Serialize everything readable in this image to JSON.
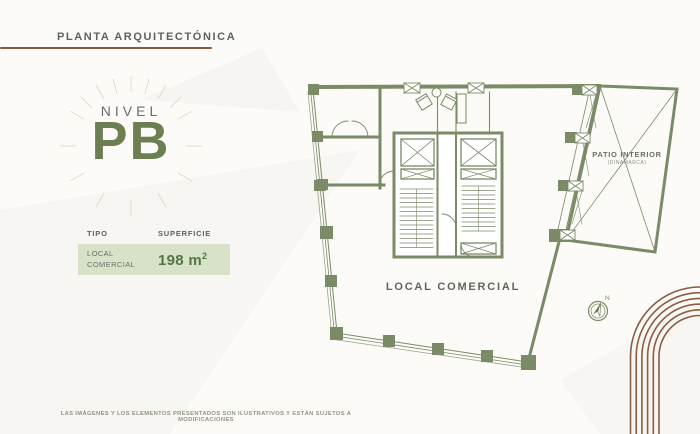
{
  "header": {
    "title": "PLANTA ARQUITECTÓNICA",
    "accent_color": "#8a573b"
  },
  "level": {
    "label": "NIVEL",
    "value": "PB",
    "value_color": "#6b7f52"
  },
  "summary_table": {
    "columns": [
      "TIPO",
      "SUPERFICIE"
    ],
    "row": {
      "tipo": "LOCAL COMERCIAL",
      "superficie_value": "198 m",
      "superficie_sup": "2"
    },
    "row_bg": "#d7e2c8",
    "value_color": "#55744a"
  },
  "plan": {
    "labels": {
      "local": "LOCAL COMERCIAL",
      "patio_title": "PATIO INTERIOR",
      "patio_subtitle": "(DINAMARCA)",
      "compass_north": "N"
    },
    "line_color": "#7b8a67"
  },
  "footer": {
    "disclaimer": "LAS IMÁGENES Y LOS ELEMENTOS PRESENTADOS SON ILUSTRATIVOS Y ESTÁN SUJETOS A MODIFICACIONES"
  },
  "decor": {
    "arc_color": "#8d5c42"
  }
}
